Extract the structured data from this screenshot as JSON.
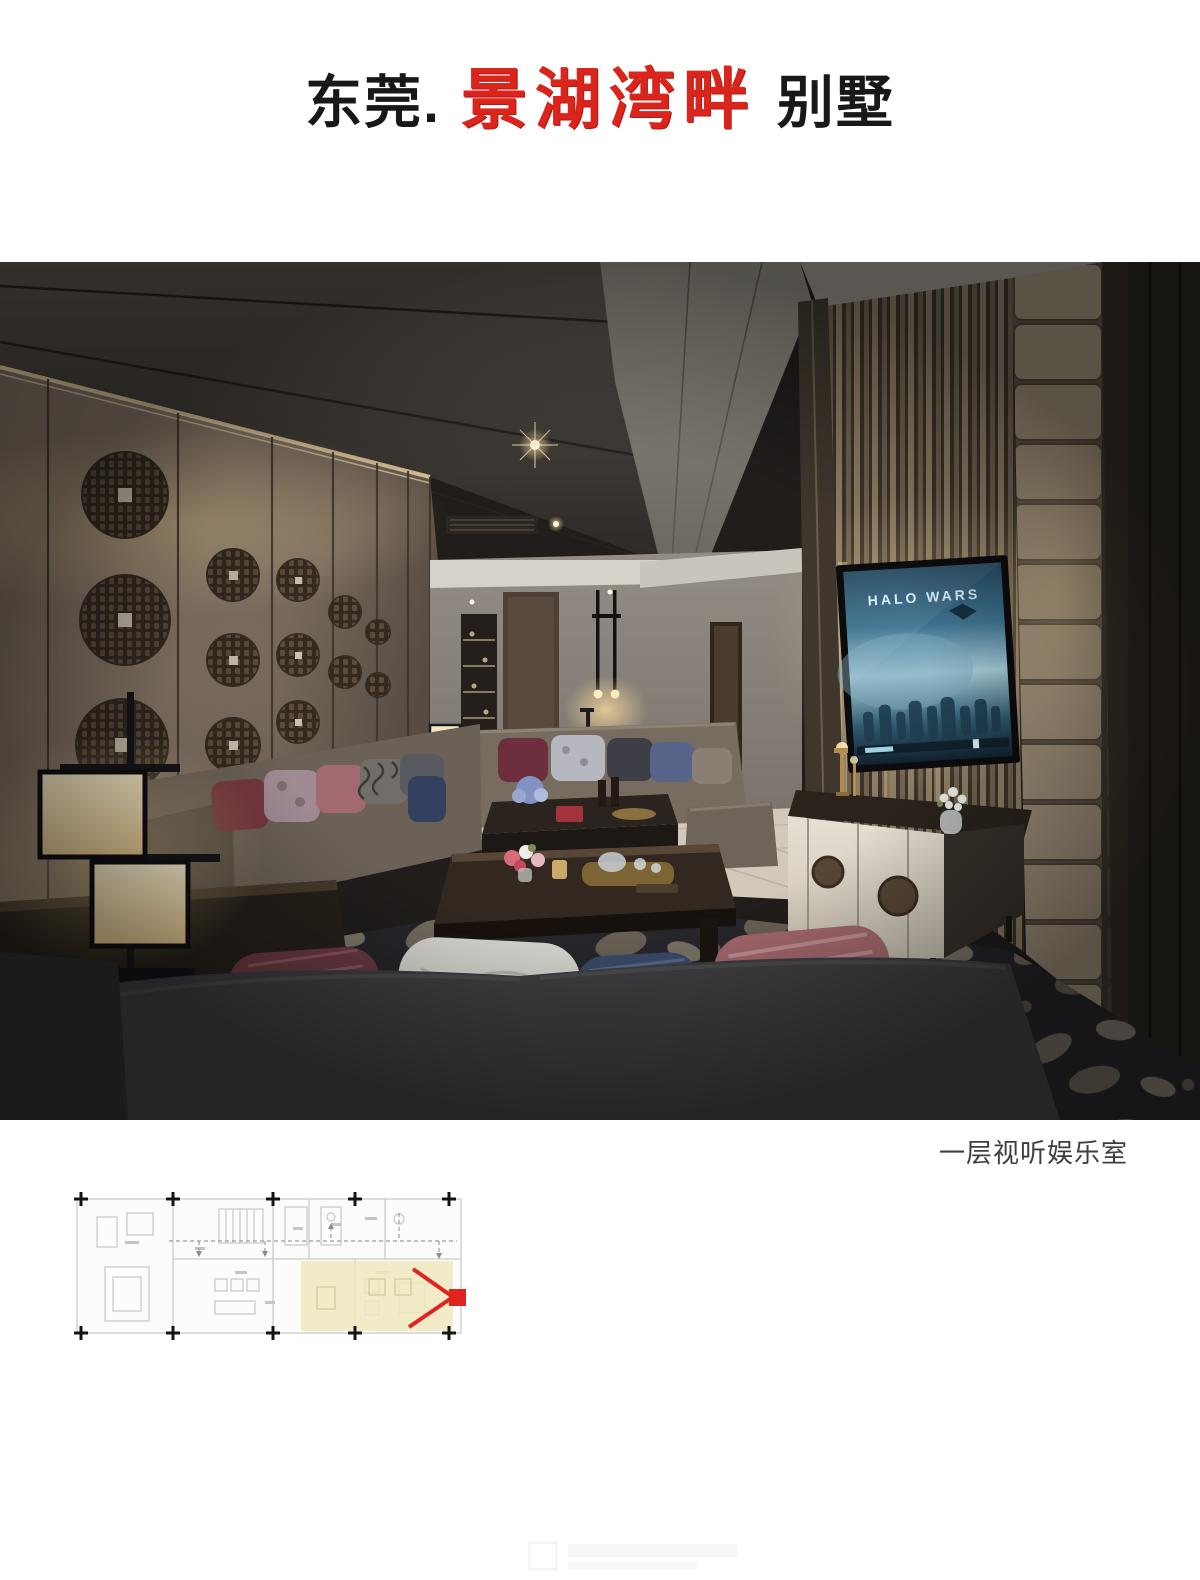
{
  "header": {
    "title_prefix": "东莞.",
    "title_highlight": "景湖湾畔",
    "title_suffix": "别墅",
    "highlight_color": "#da251c"
  },
  "photo": {
    "caption": "一层视听娱乐室",
    "tv_screen_title": "HALO WARS"
  },
  "floor_plan": {
    "highlight_color": "#efe8bd",
    "camera_marker_color": "#e02420"
  },
  "colors": {
    "page_background": "#ffffff",
    "accent_red": "#da251c",
    "title_text": "#181818",
    "caption_text": "#3e3e3e"
  }
}
